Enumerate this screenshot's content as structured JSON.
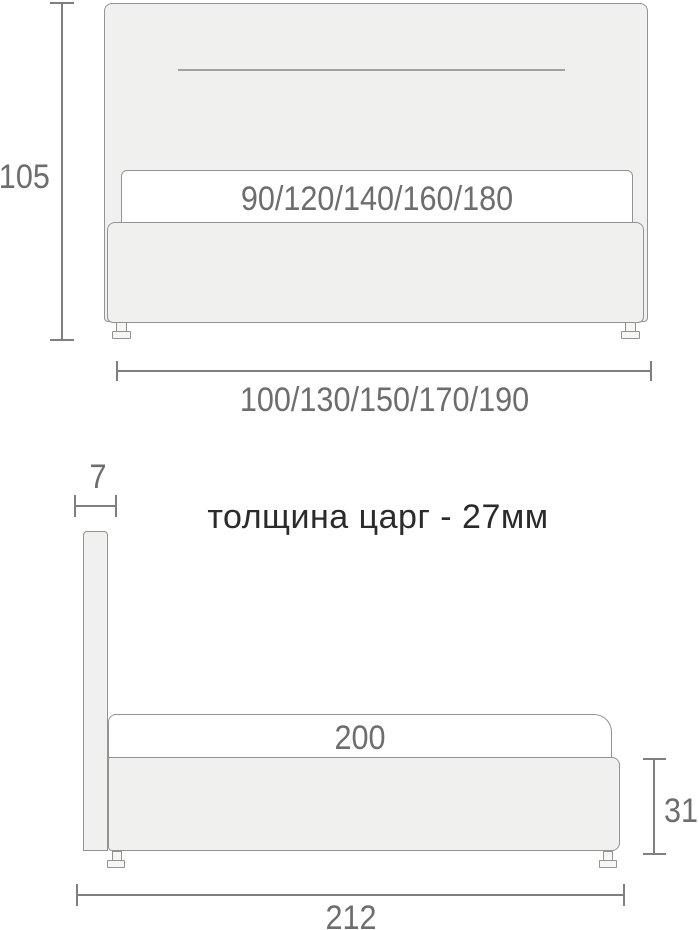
{
  "note": "толщина царг - 27мм",
  "front_view": {
    "height": "105",
    "mattress_widths": "90/120/140/160/180",
    "overall_widths": "100/130/150/170/190"
  },
  "side_view": {
    "headboard_thickness": "7",
    "sleeping_length": "200",
    "frame_height": "31",
    "overall_length": "212"
  },
  "colors": {
    "background": "#ffffff",
    "furniture_fill": "#f0f0ee",
    "mattress_fill": "#ffffff",
    "leg_fill": "#f6f6f5",
    "furniture_border": "#939393",
    "dimension_line": "#7f7f7f",
    "dimension_text": "#6d6d6d",
    "note_text": "#2b2b2b"
  }
}
